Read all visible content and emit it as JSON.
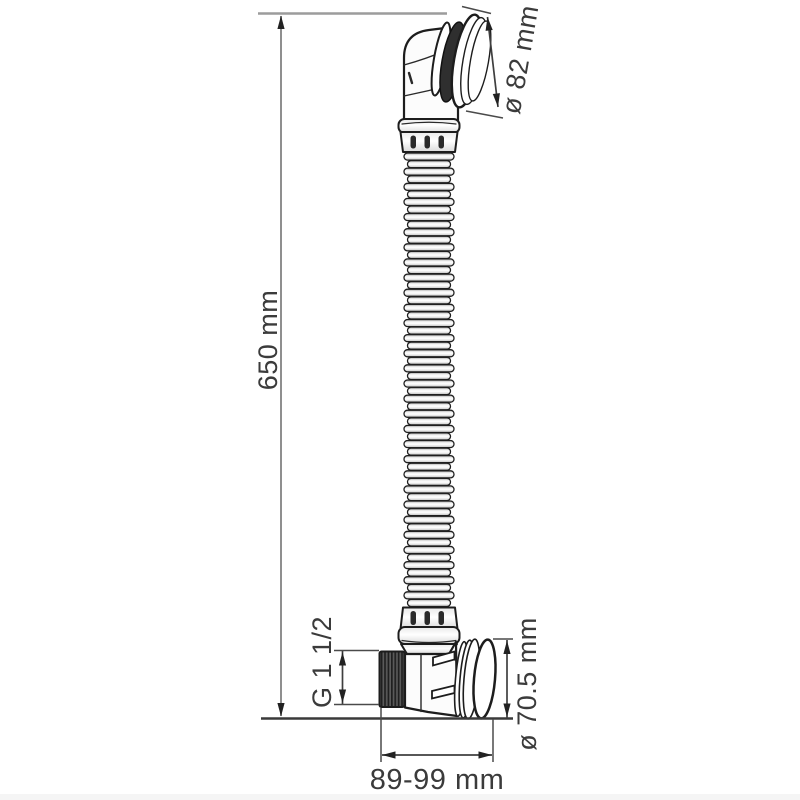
{
  "page": {
    "background_color": "#ffffff",
    "footer_strip_color": "#f5f5f5"
  },
  "drawing": {
    "type": "technical-dimension-drawing",
    "subject": "bathtub drain set with elbow outlet, flexible corrugated overflow hose and threaded overflow elbow",
    "colors": {
      "object_line": "#1d1d1d",
      "dimension_line": "#3f3f3f",
      "guide_line": "#9c9c9c",
      "text": "#3b3b3b",
      "gasket_fill": "#2f2f2f"
    },
    "labels": {
      "overall_height": "650 mm",
      "drain_cap_diameter": "ø 82 mm",
      "thread_size": "G 1 1/2",
      "overflow_flange_diameter": "ø 70.5 mm",
      "length_range": "89-99 mm"
    }
  }
}
